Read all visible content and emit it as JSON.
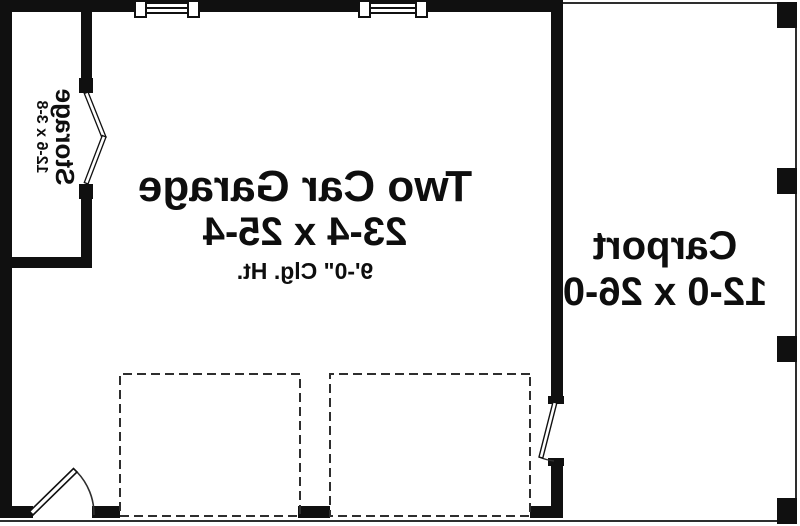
{
  "plan": {
    "garage": {
      "name": "Two Car Garage",
      "dimensions": "23-4 x 25-4",
      "ceiling": "9'-0\" Clg. Ht."
    },
    "carport": {
      "name": "Carport",
      "dimensions": "12-0 x 26-0"
    },
    "storage": {
      "name": "Storage",
      "dimensions": "12-6 x 3-8"
    },
    "colors": {
      "wall": "#101010",
      "line": "#2e2e2e",
      "background": "#ffffff"
    }
  }
}
